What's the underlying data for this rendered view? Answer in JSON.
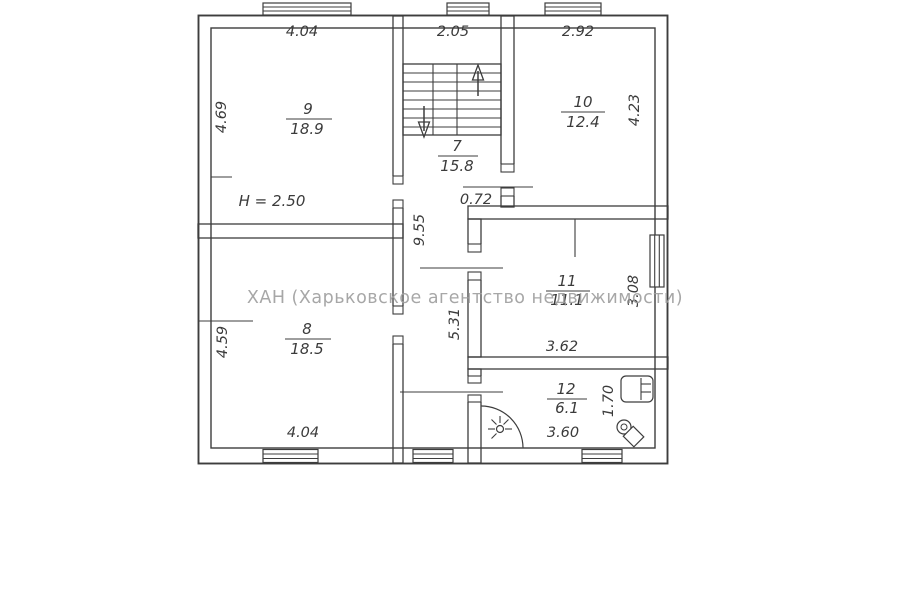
{
  "watermark": {
    "text": "ХАН (Харьковское агентство недвижимости)"
  },
  "plan": {
    "ceiling_height": "H = 2.50",
    "rooms": {
      "r9": {
        "number": "9",
        "area": "18.9"
      },
      "r7": {
        "number": "7",
        "area": "15.8"
      },
      "r10": {
        "number": "10",
        "area": "12.4"
      },
      "r8": {
        "number": "8",
        "area": "18.5"
      },
      "r11": {
        "number": "11",
        "area": "11.1"
      },
      "r12": {
        "number": "12",
        "area": "6.1"
      }
    },
    "dims": {
      "top_room9": "4.04",
      "top_stairs": "2.05",
      "top_room10": "2.92",
      "left_room9": "4.69",
      "left_room8": "4.59",
      "right_room10": "4.23",
      "right_room11": "3.08",
      "right_room12": "1.70",
      "bottom_room8": "4.04",
      "bottom_room12": "3.60",
      "corridor_length_upper": "9.55",
      "corridor_length_lower": "5.31",
      "door_width": "0.72",
      "room11_width": "3.62"
    }
  },
  "colors": {
    "line": "#3d3d3d",
    "watermark": "#9e9e9e",
    "background": "#ffffff"
  }
}
